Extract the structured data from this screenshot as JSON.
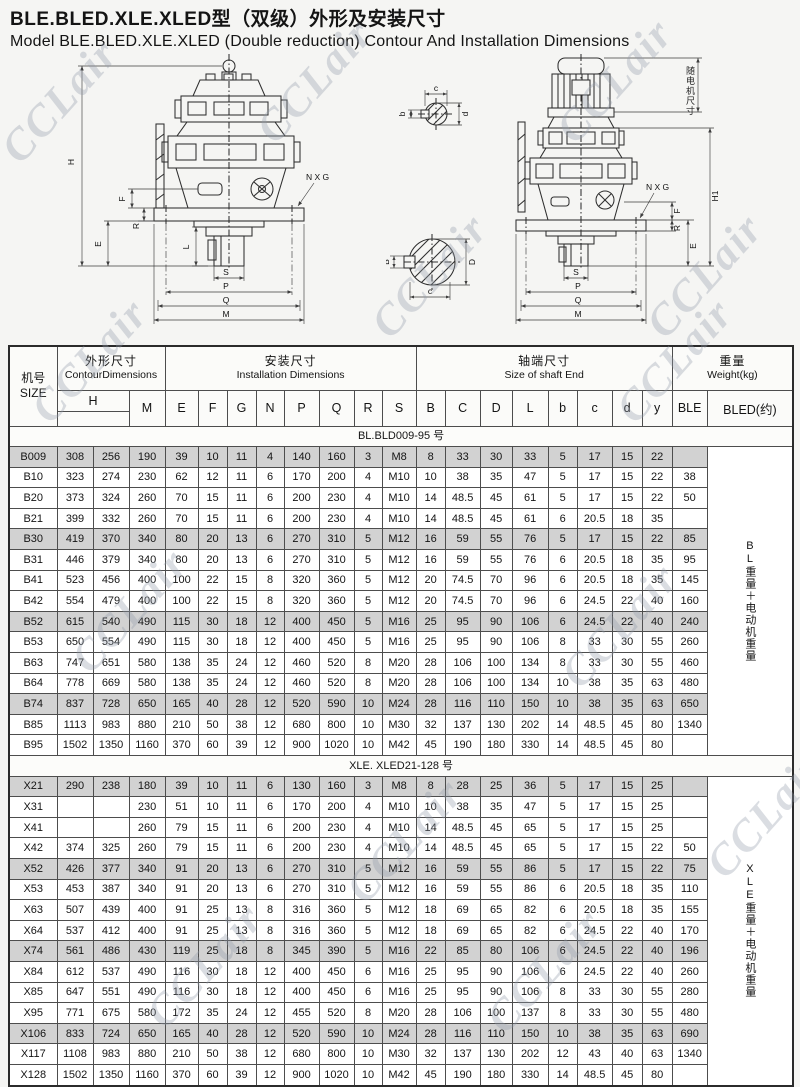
{
  "watermark": "CCLair",
  "title": {
    "zh": "BLE.BLED.XLE.XLED型（双级）外形及安装尺寸",
    "en": "Model BLE.BLED.XLE.XLED  (Double  reduction) Contour And Installation Dimensions"
  },
  "drawings": {
    "left": {
      "H": "H",
      "F": "F",
      "E": "E",
      "R": "R",
      "L": "L",
      "S": "S",
      "P": "P",
      "Q": "Q",
      "M": "M",
      "NXG": "N X G"
    },
    "right": {
      "motor_note": "随电机尺寸",
      "H1": "H1",
      "F": "F",
      "E": "E",
      "R": "R",
      "S": "S",
      "P": "P",
      "Q": "Q",
      "M": "M",
      "NXG": "N X G"
    },
    "small_shaft_section": {
      "b": "b",
      "c": "c",
      "d": "d"
    },
    "large_shaft_section": {
      "B": "B",
      "D": "D",
      "c": "c"
    }
  },
  "table": {
    "size_header": {
      "zh": "机号",
      "en": "SIZE"
    },
    "groups": [
      {
        "zh": "外形尺寸",
        "en": "ContourDimensions",
        "span": 3
      },
      {
        "zh": "安装尺寸",
        "en": "Installation   Dimensions",
        "span": 8
      },
      {
        "zh": "轴端尺寸",
        "en": "Size of shaft End",
        "span": 8
      },
      {
        "zh": "重量",
        "en": "Weight(kg)",
        "span": 2
      }
    ],
    "columns": [
      {
        "label": "H",
        "span": 2,
        "underline": true
      },
      {
        "label": "M"
      },
      {
        "label": "E"
      },
      {
        "label": "F"
      },
      {
        "label": "G"
      },
      {
        "label": "N"
      },
      {
        "label": "P"
      },
      {
        "label": "Q"
      },
      {
        "label": "R"
      },
      {
        "label": "S"
      },
      {
        "label": "B"
      },
      {
        "label": "C"
      },
      {
        "label": "D"
      },
      {
        "label": "L"
      },
      {
        "label": "b"
      },
      {
        "label": "c"
      },
      {
        "label": "d"
      },
      {
        "label": "y"
      },
      {
        "label": "BLE"
      },
      {
        "label": "BLED(约)"
      }
    ],
    "sections": [
      {
        "label": "BL.BLD009-95 号",
        "side_note": "BL重量＋电动机重量",
        "rows": [
          [
            "B009",
            "308",
            "256",
            "190",
            "39",
            "10",
            "11",
            "4",
            "140",
            "160",
            "3",
            "M8",
            "8",
            "33",
            "30",
            "33",
            "5",
            "17",
            "15",
            "22",
            ""
          ],
          [
            "B10",
            "323",
            "274",
            "230",
            "62",
            "12",
            "11",
            "6",
            "170",
            "200",
            "4",
            "M10",
            "10",
            "38",
            "35",
            "47",
            "5",
            "17",
            "15",
            "22",
            "38"
          ],
          [
            "B20",
            "373",
            "324",
            "260",
            "70",
            "15",
            "11",
            "6",
            "200",
            "230",
            "4",
            "M10",
            "14",
            "48.5",
            "45",
            "61",
            "5",
            "17",
            "15",
            "22",
            "50"
          ],
          [
            "B21",
            "399",
            "332",
            "260",
            "70",
            "15",
            "11",
            "6",
            "200",
            "230",
            "4",
            "M10",
            "14",
            "48.5",
            "45",
            "61",
            "6",
            "20.5",
            "18",
            "35",
            ""
          ],
          [
            "B30",
            "419",
            "370",
            "340",
            "80",
            "20",
            "13",
            "6",
            "270",
            "310",
            "5",
            "M12",
            "16",
            "59",
            "55",
            "76",
            "5",
            "17",
            "15",
            "22",
            "85"
          ],
          [
            "B31",
            "446",
            "379",
            "340",
            "80",
            "20",
            "13",
            "6",
            "270",
            "310",
            "5",
            "M12",
            "16",
            "59",
            "55",
            "76",
            "6",
            "20.5",
            "18",
            "35",
            "95"
          ],
          [
            "B41",
            "523",
            "456",
            "400",
            "100",
            "22",
            "15",
            "8",
            "320",
            "360",
            "5",
            "M12",
            "20",
            "74.5",
            "70",
            "96",
            "6",
            "20.5",
            "18",
            "35",
            "145"
          ],
          [
            "B42",
            "554",
            "479",
            "400",
            "100",
            "22",
            "15",
            "8",
            "320",
            "360",
            "5",
            "M12",
            "20",
            "74.5",
            "70",
            "96",
            "6",
            "24.5",
            "22",
            "40",
            "160"
          ],
          [
            "B52",
            "615",
            "540",
            "490",
            "115",
            "30",
            "18",
            "12",
            "400",
            "450",
            "5",
            "M16",
            "25",
            "95",
            "90",
            "106",
            "6",
            "24.5",
            "22",
            "40",
            "240"
          ],
          [
            "B53",
            "650",
            "554",
            "490",
            "115",
            "30",
            "18",
            "12",
            "400",
            "450",
            "5",
            "M16",
            "25",
            "95",
            "90",
            "106",
            "8",
            "33",
            "30",
            "55",
            "260"
          ],
          [
            "B63",
            "747",
            "651",
            "580",
            "138",
            "35",
            "24",
            "12",
            "460",
            "520",
            "8",
            "M20",
            "28",
            "106",
            "100",
            "134",
            "8",
            "33",
            "30",
            "55",
            "460"
          ],
          [
            "B64",
            "778",
            "669",
            "580",
            "138",
            "35",
            "24",
            "12",
            "460",
            "520",
            "8",
            "M20",
            "28",
            "106",
            "100",
            "134",
            "10",
            "38",
            "35",
            "63",
            "480"
          ],
          [
            "B74",
            "837",
            "728",
            "650",
            "165",
            "40",
            "28",
            "12",
            "520",
            "590",
            "10",
            "M24",
            "28",
            "116",
            "110",
            "150",
            "10",
            "38",
            "35",
            "63",
            "650"
          ],
          [
            "B85",
            "1113",
            "983",
            "880",
            "210",
            "50",
            "38",
            "12",
            "680",
            "800",
            "10",
            "M30",
            "32",
            "137",
            "130",
            "202",
            "14",
            "48.5",
            "45",
            "80",
            "1340"
          ],
          [
            "B95",
            "1502",
            "1350",
            "1160",
            "370",
            "60",
            "39",
            "12",
            "900",
            "1020",
            "10",
            "M42",
            "45",
            "190",
            "180",
            "330",
            "14",
            "48.5",
            "45",
            "80",
            ""
          ]
        ]
      },
      {
        "label": "XLE. XLED21-128 号",
        "side_note": "XLE重量＋电动机重量",
        "rows": [
          [
            "X21",
            "290",
            "238",
            "180",
            "39",
            "10",
            "11",
            "6",
            "130",
            "160",
            "3",
            "M8",
            "8",
            "28",
            "25",
            "36",
            "5",
            "17",
            "15",
            "25",
            ""
          ],
          [
            "X31",
            "",
            "",
            "230",
            "51",
            "10",
            "11",
            "6",
            "170",
            "200",
            "4",
            "M10",
            "10",
            "38",
            "35",
            "47",
            "5",
            "17",
            "15",
            "25",
            ""
          ],
          [
            "X41",
            "",
            "",
            "260",
            "79",
            "15",
            "11",
            "6",
            "200",
            "230",
            "4",
            "M10",
            "14",
            "48.5",
            "45",
            "65",
            "5",
            "17",
            "15",
            "25",
            ""
          ],
          [
            "X42",
            "374",
            "325",
            "260",
            "79",
            "15",
            "11",
            "6",
            "200",
            "230",
            "4",
            "M10",
            "14",
            "48.5",
            "45",
            "65",
            "5",
            "17",
            "15",
            "22",
            "50"
          ],
          [
            "X52",
            "426",
            "377",
            "340",
            "91",
            "20",
            "13",
            "6",
            "270",
            "310",
            "5",
            "M12",
            "16",
            "59",
            "55",
            "86",
            "5",
            "17",
            "15",
            "22",
            "75"
          ],
          [
            "X53",
            "453",
            "387",
            "340",
            "91",
            "20",
            "13",
            "6",
            "270",
            "310",
            "5",
            "M12",
            "16",
            "59",
            "55",
            "86",
            "6",
            "20.5",
            "18",
            "35",
            "110"
          ],
          [
            "X63",
            "507",
            "439",
            "400",
            "91",
            "25",
            "13",
            "8",
            "316",
            "360",
            "5",
            "M12",
            "18",
            "69",
            "65",
            "82",
            "6",
            "20.5",
            "18",
            "35",
            "155"
          ],
          [
            "X64",
            "537",
            "412",
            "400",
            "91",
            "25",
            "13",
            "8",
            "316",
            "360",
            "5",
            "M12",
            "18",
            "69",
            "65",
            "82",
            "6",
            "24.5",
            "22",
            "40",
            "170"
          ],
          [
            "X74",
            "561",
            "486",
            "430",
            "119",
            "25",
            "18",
            "8",
            "345",
            "390",
            "5",
            "M16",
            "22",
            "85",
            "80",
            "106",
            "6",
            "24.5",
            "22",
            "40",
            "196"
          ],
          [
            "X84",
            "612",
            "537",
            "490",
            "116",
            "30",
            "18",
            "12",
            "400",
            "450",
            "6",
            "M16",
            "25",
            "95",
            "90",
            "106",
            "6",
            "24.5",
            "22",
            "40",
            "260"
          ],
          [
            "X85",
            "647",
            "551",
            "490",
            "116",
            "30",
            "18",
            "12",
            "400",
            "450",
            "6",
            "M16",
            "25",
            "95",
            "90",
            "106",
            "8",
            "33",
            "30",
            "55",
            "280"
          ],
          [
            "X95",
            "771",
            "675",
            "580",
            "172",
            "35",
            "24",
            "12",
            "455",
            "520",
            "8",
            "M20",
            "28",
            "106",
            "100",
            "137",
            "8",
            "33",
            "30",
            "55",
            "480"
          ],
          [
            "X106",
            "833",
            "724",
            "650",
            "165",
            "40",
            "28",
            "12",
            "520",
            "590",
            "10",
            "M24",
            "28",
            "116",
            "110",
            "150",
            "10",
            "38",
            "35",
            "63",
            "690"
          ],
          [
            "X117",
            "1108",
            "983",
            "880",
            "210",
            "50",
            "38",
            "12",
            "680",
            "800",
            "10",
            "M30",
            "32",
            "137",
            "130",
            "202",
            "12",
            "43",
            "40",
            "63",
            "1340"
          ],
          [
            "X128",
            "1502",
            "1350",
            "1160",
            "370",
            "60",
            "39",
            "12",
            "900",
            "1020",
            "10",
            "M42",
            "45",
            "190",
            "180",
            "330",
            "14",
            "48.5",
            "45",
            "80",
            ""
          ]
        ]
      }
    ]
  }
}
